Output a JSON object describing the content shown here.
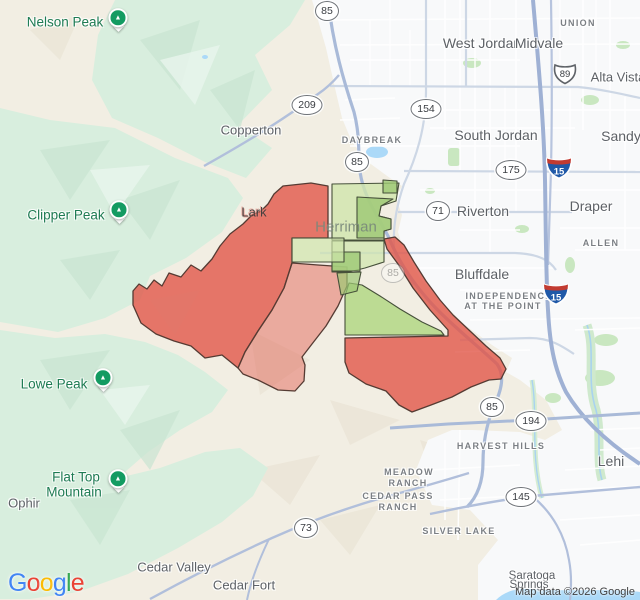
{
  "attribution": "Map data ©2026 Google",
  "logo": {
    "letters": [
      "G",
      "o",
      "o",
      "g",
      "l",
      "e"
    ]
  },
  "colors": {
    "land": "#f2eee3",
    "urban": "#f8f9fa",
    "mountain": "#d8eede",
    "water": "#abd9f8",
    "highway": "#a9bad8",
    "districtRed": "#e15649",
    "districtRedLightOpacity": 0.45,
    "districtGreenLight": "#cfe5ab",
    "districtGreenMedium": "#9cc873",
    "districtGreenBright": "#aad478",
    "overlayStroke": "#553b33",
    "greenStroke": "#46503a",
    "peakPinGreen": "#149b62",
    "cityLabel": "#5d6166",
    "peakLabel": "#1e7b53"
  },
  "labels": [
    {
      "t": "Nelson Peak"
    },
    {
      "t": "Clipper Peak"
    },
    {
      "t": "Lowe Peak"
    },
    {
      "t": "Flat Top"
    },
    {
      "t": "Mountain"
    },
    {
      "t": "Ophir"
    },
    {
      "t": "Copperton"
    },
    {
      "t": "Lark"
    },
    {
      "t": "Herriman"
    },
    {
      "t": "West Jordan"
    },
    {
      "t": "Midvale"
    },
    {
      "t": "UNION"
    },
    {
      "t": "Alta Vista"
    },
    {
      "t": "South Jordan"
    },
    {
      "t": "Sandy"
    },
    {
      "t": "DAYBREAK"
    },
    {
      "t": "Riverton"
    },
    {
      "t": "Draper"
    },
    {
      "t": "ALLEN"
    },
    {
      "t": "Bluffdale"
    },
    {
      "t": "INDEPENDENCE"
    },
    {
      "t": "AT THE POINT"
    },
    {
      "t": "HARVEST HILLS"
    },
    {
      "t": "Lehi"
    },
    {
      "t": "MEADOW"
    },
    {
      "t": "RANCH"
    },
    {
      "t": "CEDAR PASS"
    },
    {
      "t": "RANCH"
    },
    {
      "t": "SILVER LAKE"
    },
    {
      "t": "Cedar Valley"
    },
    {
      "t": "Cedar Fort"
    },
    {
      "t": "Saratoga"
    },
    {
      "t": "Springs"
    }
  ],
  "shields": [
    {
      "label": "85"
    },
    {
      "label": "209"
    },
    {
      "label": "154"
    },
    {
      "label": "85"
    },
    {
      "label": "175"
    },
    {
      "label": "89"
    },
    {
      "label": "15"
    },
    {
      "label": "71"
    },
    {
      "label": "15"
    },
    {
      "label": "85"
    },
    {
      "label": "85"
    },
    {
      "label": "194"
    },
    {
      "label": "145"
    },
    {
      "label": "73"
    }
  ]
}
